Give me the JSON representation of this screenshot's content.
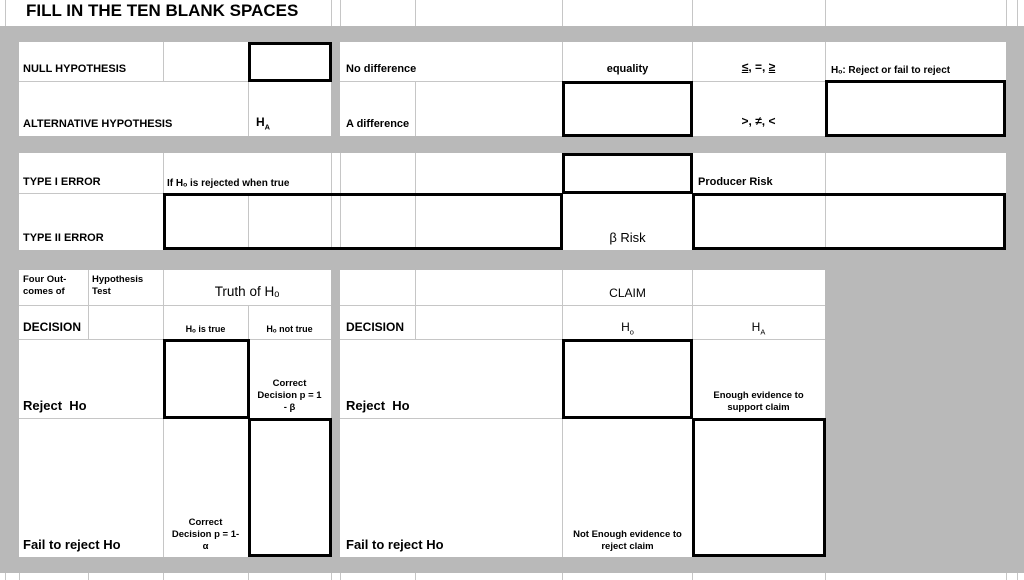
{
  "sheet": {
    "title": "FILL IN THE TEN BLANK SPACES"
  },
  "colors": {
    "background": "#b9b9b9",
    "gridline": "#c6c6c6",
    "cell_background": "#ffffff",
    "blank_box_border": "#000000",
    "text": "#000000"
  },
  "hypothesis": {
    "null": {
      "label": "NULL HYPOTHESIS",
      "difference": "No difference",
      "meaning": "equality",
      "sign_le": "≤",
      "sign_mid": ", =, ",
      "sign_ge": "≥",
      "note": "Hₒ: Reject or fail to reject"
    },
    "alternative": {
      "label": "ALTERNATIVE HYPOTHESIS",
      "symbol": {
        "base": "H",
        "sub": "A"
      },
      "difference": "A difference",
      "signs": ">, ≠, <"
    }
  },
  "errors": {
    "type1": {
      "label": "TYPE I ERROR",
      "definition": "If Hₒ is rejected when true",
      "risk": "Producer Risk"
    },
    "type2": {
      "label": "TYPE II ERROR",
      "risk": "β Risk"
    }
  },
  "outcomes": {
    "corner1": "Four Out-\ncomes of",
    "corner2": "Hypothesis\nTest",
    "column_group": "Truth of Hₒ",
    "decision": "DECISION",
    "col_true": "Hₒ is true",
    "col_not_true": "Hₒ not true",
    "reject": "Reject  Ho",
    "reject_correct": "Correct\nDecision p = 1\n- β",
    "fail": "Fail to reject Ho",
    "fail_correct": "Correct\nDecision p = 1-\nα"
  },
  "claim": {
    "column_group": "CLAIM",
    "decision": "DECISION",
    "h0": {
      "base": "H",
      "sub": "o"
    },
    "ha": {
      "base": "H",
      "sub": "A"
    },
    "reject": "Reject  Ho",
    "reject_note": "Enough evidence to\nsupport claim",
    "fail": "Fail to reject Ho",
    "fail_note": "Not Enough evidence to\nreject claim"
  }
}
